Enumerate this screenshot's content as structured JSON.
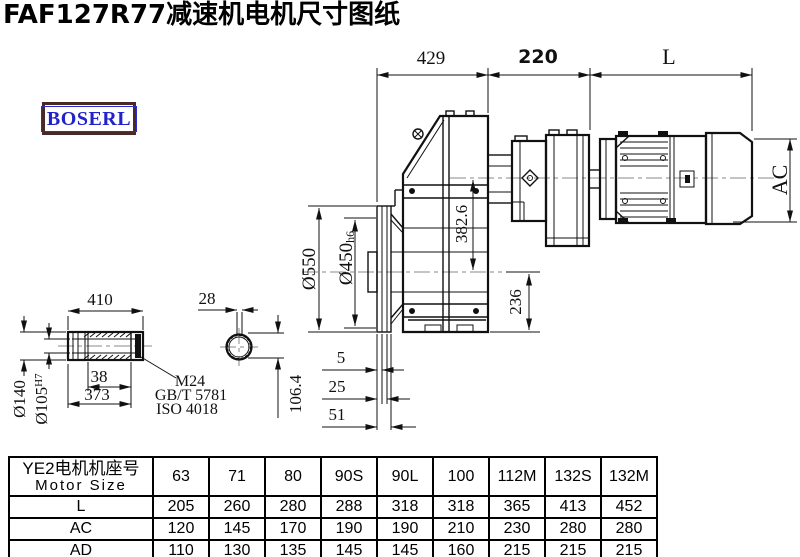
{
  "title": "FAF127R77减速机电机尺寸图纸",
  "logo": {
    "text": "BOSERL",
    "text_color": "#2222cc",
    "border_color": "#4a2a26"
  },
  "drawing": {
    "line_color": "#111111",
    "centerline_color": "#888888",
    "top_dims": {
      "d429": "429",
      "d220": "220",
      "dL": "L"
    },
    "right_dims": {
      "ac": "AC"
    },
    "main_dims": {
      "d382_6": "382.6",
      "d236": "236"
    },
    "flange_dims": {
      "d550": "Ø550",
      "d450": "Ø450",
      "d450_tol": "h6",
      "s5": "5",
      "s25": "25",
      "s51": "51"
    },
    "shaft_dims": {
      "d410": "410",
      "d38": "38",
      "d373": "373",
      "d140": "Ø140",
      "d105": "Ø105",
      "d105_tol": "H7"
    },
    "key_dims": {
      "d28": "28",
      "d106_4": "106.4"
    },
    "callout": {
      "thread": "M24",
      "std1": "GB/T 5781",
      "std2": "ISO 4018"
    }
  },
  "table": {
    "header_cn": "YE2电机机座号",
    "header_en": "Motor Size",
    "columns": [
      "63",
      "71",
      "80",
      "90S",
      "90L",
      "100",
      "112M",
      "132S",
      "132M"
    ],
    "rows": [
      {
        "label": "L",
        "values": [
          "205",
          "260",
          "280",
          "288",
          "318",
          "318",
          "365",
          "413",
          "452"
        ]
      },
      {
        "label": "AC",
        "values": [
          "120",
          "145",
          "170",
          "190",
          "190",
          "210",
          "230",
          "280",
          "280"
        ]
      },
      {
        "label": "AD",
        "values": [
          "110",
          "130",
          "135",
          "145",
          "145",
          "160",
          "215",
          "215",
          "215"
        ]
      }
    ]
  }
}
